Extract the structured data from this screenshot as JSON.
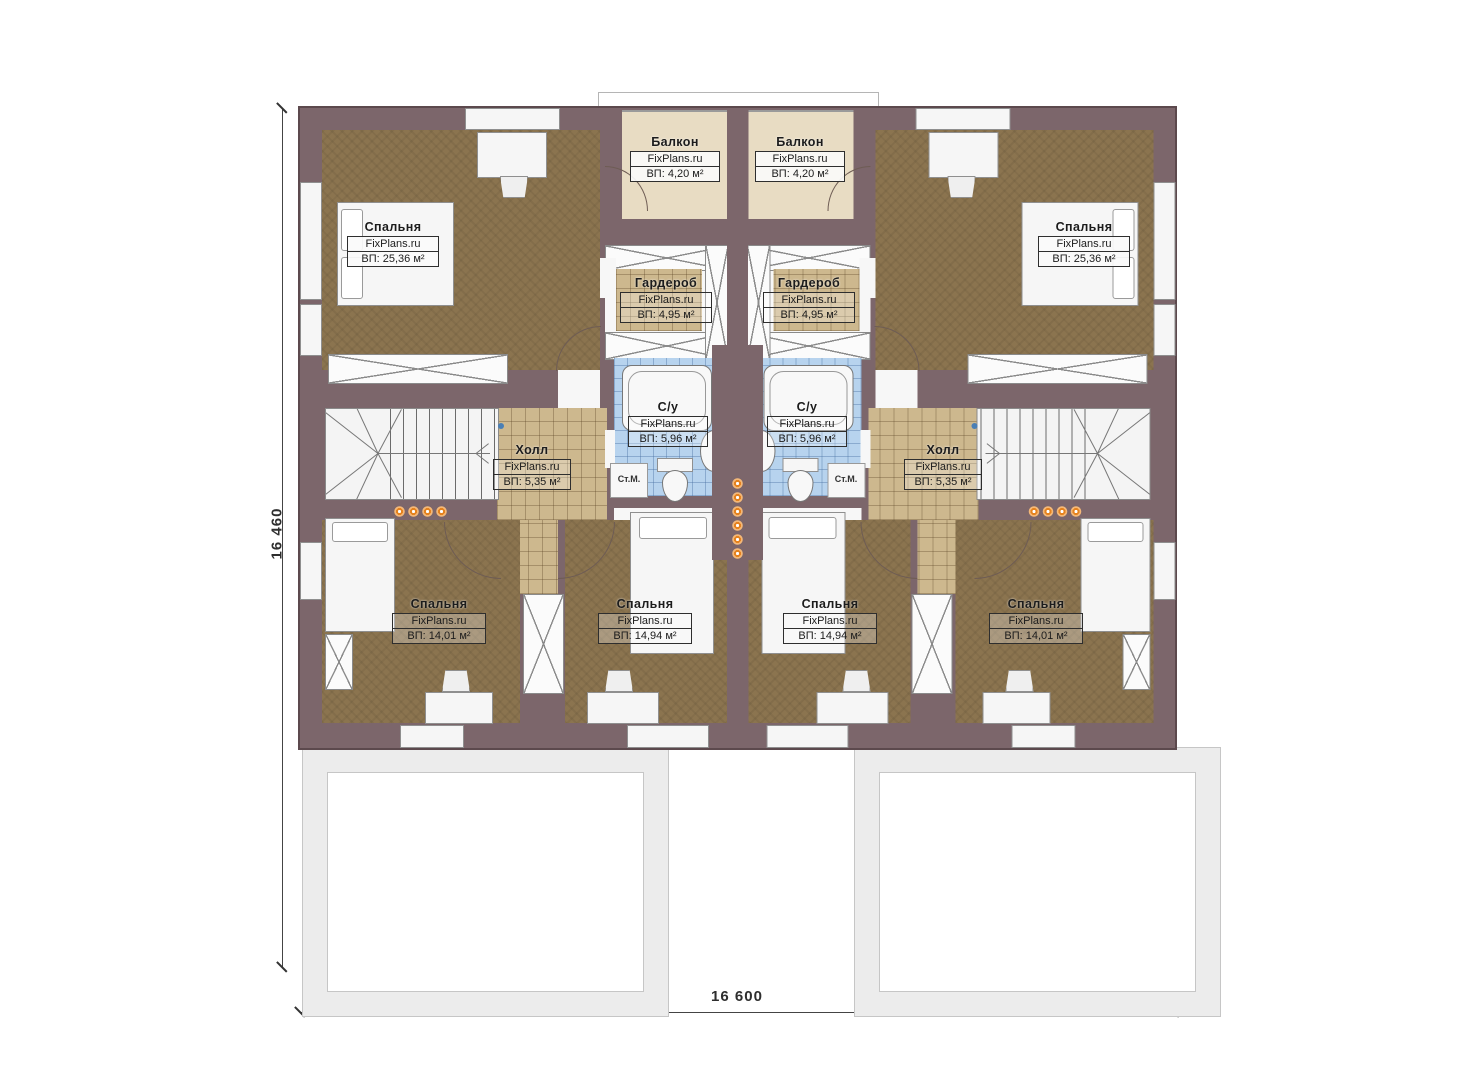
{
  "title": "Floor plan — second storey of mirrored duplex house",
  "watermark": "FixPlans.ru",
  "dimensions": {
    "vertical": "16 460",
    "horizontal": "16 600"
  },
  "annotations": {
    "washing_machine": "Ст.М."
  },
  "rooms": [
    {
      "id": "balcony-left",
      "name": "Балкон",
      "area": "ВП: 4,20 м²"
    },
    {
      "id": "balcony-right",
      "name": "Балкон",
      "area": "ВП: 4,20 м²"
    },
    {
      "id": "bedroom-top-left",
      "name": "Спальня",
      "area": "ВП: 25,36 м²"
    },
    {
      "id": "bedroom-top-right",
      "name": "Спальня",
      "area": "ВП: 25,36 м²"
    },
    {
      "id": "wardrobe-left",
      "name": "Гардероб",
      "area": "ВП: 4,95 м²"
    },
    {
      "id": "wardrobe-right",
      "name": "Гардероб",
      "area": "ВП: 4,95 м²"
    },
    {
      "id": "bathroom-left",
      "name": "С/у",
      "area": "ВП: 5,96 м²"
    },
    {
      "id": "bathroom-right",
      "name": "С/у",
      "area": "ВП: 5,96 м²"
    },
    {
      "id": "hall-left",
      "name": "Холл",
      "area": "ВП: 5,35 м²"
    },
    {
      "id": "hall-right",
      "name": "Холл",
      "area": "ВП: 5,35 м²"
    },
    {
      "id": "bedroom-bottom-left",
      "name": "Спальня",
      "area": "ВП: 14,01 м²"
    },
    {
      "id": "bedroom-bottom-midleft",
      "name": "Спальня",
      "area": "ВП: 14,94 м²"
    },
    {
      "id": "bedroom-bottom-midright",
      "name": "Спальня",
      "area": "ВП: 14,94 м²"
    },
    {
      "id": "bedroom-bottom-right",
      "name": "Спальня",
      "area": "ВП: 14,01 м²"
    }
  ],
  "colors": {
    "wall": "#7c666b",
    "wall_outline": "#5c494d",
    "wood_floor": "#8b744f",
    "tile_floor": "#cdb88e",
    "bath_tile": "#b7d3ee",
    "balcony_floor": "#e8dcc3",
    "spotlight": "#e5821e",
    "terrace_frame": "#ececec"
  }
}
